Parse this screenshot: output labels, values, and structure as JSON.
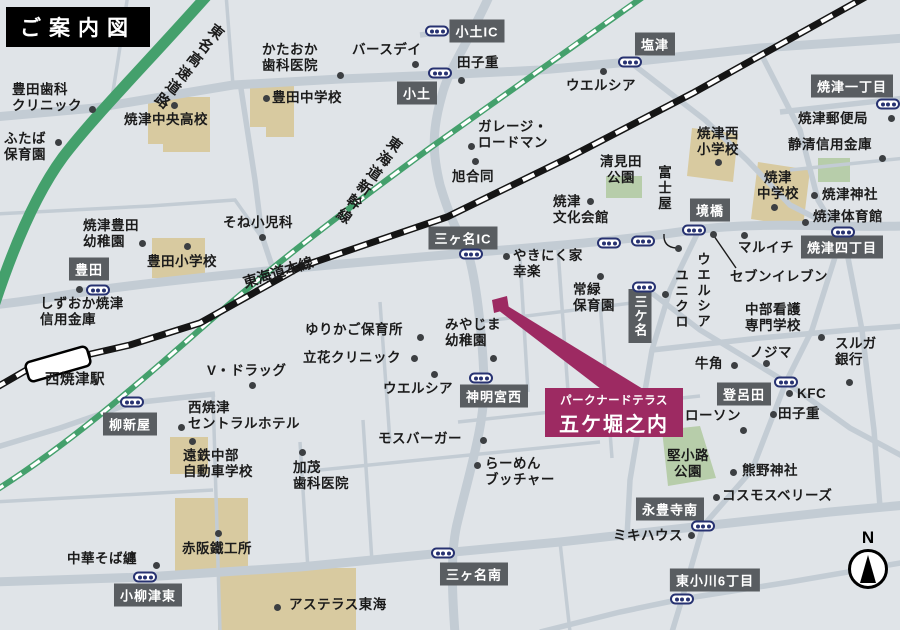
{
  "title": "ご案内図",
  "compass_label": "N",
  "colors": {
    "background": "#e0e4e8",
    "road": "#c3ccd4",
    "expressway_green": "#44a06c",
    "rail_black": "#151515",
    "rail_white": "#ffffff",
    "building": "#d8caa0",
    "park": "#b7cdaa",
    "badge": "#595d61",
    "badge_text": "#ffffff",
    "label_text": "#1b1b1b",
    "accent_magenta": "#9d2a62",
    "signal_navy": "#273271",
    "dot": "#3c3f42"
  },
  "property": {
    "line1": "パークナードテラス",
    "line2": "五ケ堀之内"
  },
  "station": {
    "name": "西焼津駅",
    "label_x": 45,
    "label_y": 372
  },
  "road_names": [
    {
      "text": "東名高速道路",
      "x": 188,
      "y": 14,
      "rotate": 38,
      "vertical": true
    },
    {
      "text": "東海道新幹線",
      "x": 368,
      "y": 128,
      "rotate": 35,
      "vertical": true
    },
    {
      "text": "東海道本線",
      "x": 278,
      "y": 272,
      "rotate": -17,
      "vertical": false
    }
  ],
  "badges": [
    {
      "text": "小土IC",
      "x": 477,
      "y": 31
    },
    {
      "text": "小土",
      "x": 417,
      "y": 93
    },
    {
      "text": "塩津",
      "x": 655,
      "y": 44
    },
    {
      "text": "焼津一丁目",
      "x": 852,
      "y": 86
    },
    {
      "text": "三ヶ名IC",
      "x": 463,
      "y": 238
    },
    {
      "text": "豊田",
      "x": 89,
      "y": 269
    },
    {
      "text": "境橋",
      "x": 710,
      "y": 210
    },
    {
      "text": "焼津四丁目",
      "x": 842,
      "y": 247
    },
    {
      "text": "三ケ名",
      "x": 640,
      "y": 316,
      "vertical": true
    },
    {
      "text": "柳新屋",
      "x": 130,
      "y": 424
    },
    {
      "text": "神明宮西",
      "x": 494,
      "y": 396
    },
    {
      "text": "三ヶ名南",
      "x": 474,
      "y": 574
    },
    {
      "text": "小柳津東",
      "x": 148,
      "y": 595
    },
    {
      "text": "永豊寺南",
      "x": 670,
      "y": 509
    },
    {
      "text": "東小川6丁目",
      "x": 715,
      "y": 580
    },
    {
      "text": "登呂田",
      "x": 744,
      "y": 394
    }
  ],
  "places": [
    {
      "text": "豊田歯科\nクリニック",
      "x": 12,
      "y": 82,
      "dot": [
        92,
        109
      ]
    },
    {
      "text": "ふたば\n保育園",
      "x": 4,
      "y": 131,
      "dot": [
        58,
        142
      ]
    },
    {
      "text": "焼津中央高校",
      "x": 124,
      "y": 112,
      "dot": [
        174,
        105
      ]
    },
    {
      "text": "かたおか\n歯科医院",
      "x": 262,
      "y": 42,
      "dot": [
        340,
        75
      ]
    },
    {
      "text": "バースデイ",
      "x": 352,
      "y": 42,
      "dot": [
        415,
        64
      ]
    },
    {
      "text": "田子重",
      "x": 457,
      "y": 55,
      "dot": [
        461,
        80
      ]
    },
    {
      "text": "豊田中学校",
      "x": 272,
      "y": 90,
      "dot": [
        266,
        98
      ]
    },
    {
      "text": "ウエルシア",
      "x": 566,
      "y": 78,
      "dot": [
        603,
        71
      ]
    },
    {
      "text": "焼津郵便局",
      "x": 798,
      "y": 111,
      "dot": [
        891,
        118
      ]
    },
    {
      "text": "静清信用金庫",
      "x": 788,
      "y": 137,
      "dot": [
        882,
        158
      ]
    },
    {
      "text": "焼津西\n小学校",
      "x": 697,
      "y": 126,
      "dot": [
        718,
        162
      ]
    },
    {
      "text": "焼津\n中学校",
      "x": 778,
      "y": 170,
      "align": "center",
      "dot": [
        774,
        207
      ]
    },
    {
      "text": "焼津神社",
      "x": 822,
      "y": 187,
      "dot": [
        814,
        195
      ]
    },
    {
      "text": "焼津体育館",
      "x": 813,
      "y": 209,
      "dot": [
        805,
        222
      ]
    },
    {
      "text": "マルイチ",
      "x": 738,
      "y": 240,
      "dot": [
        744,
        235
      ]
    },
    {
      "text": "セブンイレブン",
      "x": 730,
      "y": 269,
      "dot": [
        713,
        234
      ]
    },
    {
      "text": "清見田\n公園",
      "x": 621,
      "y": 154,
      "align": "center"
    },
    {
      "text": "富士屋",
      "x": 663,
      "y": 165,
      "vertical": true,
      "dot": [
        678,
        248
      ]
    },
    {
      "text": "旭合同",
      "x": 452,
      "y": 169,
      "dot": [
        475,
        161
      ]
    },
    {
      "text": "ガレージ・\nロードマン",
      "x": 478,
      "y": 119,
      "dot": [
        471,
        146
      ]
    },
    {
      "text": "焼津\n文化会館",
      "x": 553,
      "y": 194,
      "dot": [
        590,
        201
      ]
    },
    {
      "text": "やきにく家\n幸楽",
      "x": 513,
      "y": 248,
      "dot": [
        506,
        256
      ]
    },
    {
      "text": "常緑\n保育園",
      "x": 573,
      "y": 282,
      "dot": [
        600,
        276
      ]
    },
    {
      "text": "ウエルシア",
      "x": 702,
      "y": 252,
      "vertical": true
    },
    {
      "text": "ユニクロ",
      "x": 680,
      "y": 268,
      "vertical": true,
      "dot": [
        665,
        294
      ]
    },
    {
      "text": "中部看護\n専門学校",
      "x": 745,
      "y": 302,
      "dot": [
        821,
        337
      ]
    },
    {
      "text": "ノジマ",
      "x": 750,
      "y": 345,
      "dot": [
        766,
        363
      ]
    },
    {
      "text": "スルガ\n銀行",
      "x": 835,
      "y": 336,
      "dot": [
        849,
        382
      ]
    },
    {
      "text": "牛角",
      "x": 695,
      "y": 356,
      "dot": [
        734,
        365
      ]
    },
    {
      "text": "KFC",
      "x": 797,
      "y": 386,
      "dot": [
        789,
        393
      ]
    },
    {
      "text": "田子重",
      "x": 778,
      "y": 406,
      "dot": [
        773,
        414
      ]
    },
    {
      "text": "ローソン",
      "x": 685,
      "y": 408,
      "dot": [
        743,
        430
      ]
    },
    {
      "text": "堅小路\n公園",
      "x": 688,
      "y": 448,
      "align": "center"
    },
    {
      "text": "熊野神社",
      "x": 742,
      "y": 463,
      "dot": [
        733,
        472
      ]
    },
    {
      "text": "コスモスベリーズ",
      "x": 722,
      "y": 488,
      "dot": [
        716,
        497
      ]
    },
    {
      "text": "ミキハウス",
      "x": 613,
      "y": 528,
      "dot": [
        691,
        535
      ]
    },
    {
      "text": "ゆりかご保育所",
      "x": 305,
      "y": 322,
      "dot": [
        420,
        337
      ]
    },
    {
      "text": "立花クリニック",
      "x": 303,
      "y": 350,
      "dot": [
        414,
        358
      ]
    },
    {
      "text": "みやじま\n幼稚園",
      "x": 445,
      "y": 317,
      "dot": [
        493,
        358
      ]
    },
    {
      "text": "ウエルシア",
      "x": 383,
      "y": 381,
      "dot": [
        434,
        374
      ]
    },
    {
      "text": "V・ドラッグ",
      "x": 207,
      "y": 363,
      "dot": [
        252,
        385
      ]
    },
    {
      "text": "西焼津\nセントラルホテル",
      "x": 188,
      "y": 400,
      "dot": [
        181,
        427
      ]
    },
    {
      "text": "遠鉄中部\n自動車学校",
      "x": 183,
      "y": 448,
      "dot": [
        192,
        441
      ]
    },
    {
      "text": "加茂\n歯科医院",
      "x": 293,
      "y": 460,
      "dot": [
        302,
        452
      ]
    },
    {
      "text": "モスバーガー",
      "x": 378,
      "y": 431,
      "dot": [
        483,
        440
      ]
    },
    {
      "text": "らーめん\nブッチャー",
      "x": 485,
      "y": 456,
      "dot": [
        477,
        465
      ]
    },
    {
      "text": "中華そば纏",
      "x": 67,
      "y": 551,
      "dot": [
        156,
        565
      ]
    },
    {
      "text": "赤阪鐵工所",
      "x": 182,
      "y": 541,
      "dot": [
        218,
        533
      ]
    },
    {
      "text": "アステラス東海",
      "x": 289,
      "y": 597,
      "dot": [
        277,
        607
      ]
    },
    {
      "text": "そね小児科",
      "x": 223,
      "y": 215,
      "dot": [
        262,
        237
      ]
    },
    {
      "text": "焼津豊田\n幼稚園",
      "x": 83,
      "y": 218,
      "dot": [
        142,
        243
      ]
    },
    {
      "text": "豊田小学校",
      "x": 147,
      "y": 254,
      "dot": [
        187,
        246
      ]
    },
    {
      "text": "しずおか焼津\n信用金庫",
      "x": 40,
      "y": 296,
      "dot": [
        79,
        289
      ]
    }
  ],
  "signals": [
    [
      437,
      31
    ],
    [
      440,
      73
    ],
    [
      630,
      62
    ],
    [
      888,
      104
    ],
    [
      98,
      290
    ],
    [
      471,
      254
    ],
    [
      609,
      243
    ],
    [
      643,
      241
    ],
    [
      694,
      230
    ],
    [
      843,
      232
    ],
    [
      644,
      287
    ],
    [
      132,
      402
    ],
    [
      481,
      378
    ],
    [
      443,
      553
    ],
    [
      145,
      577
    ],
    [
      703,
      526
    ],
    [
      682,
      599
    ],
    [
      786,
      382
    ]
  ]
}
